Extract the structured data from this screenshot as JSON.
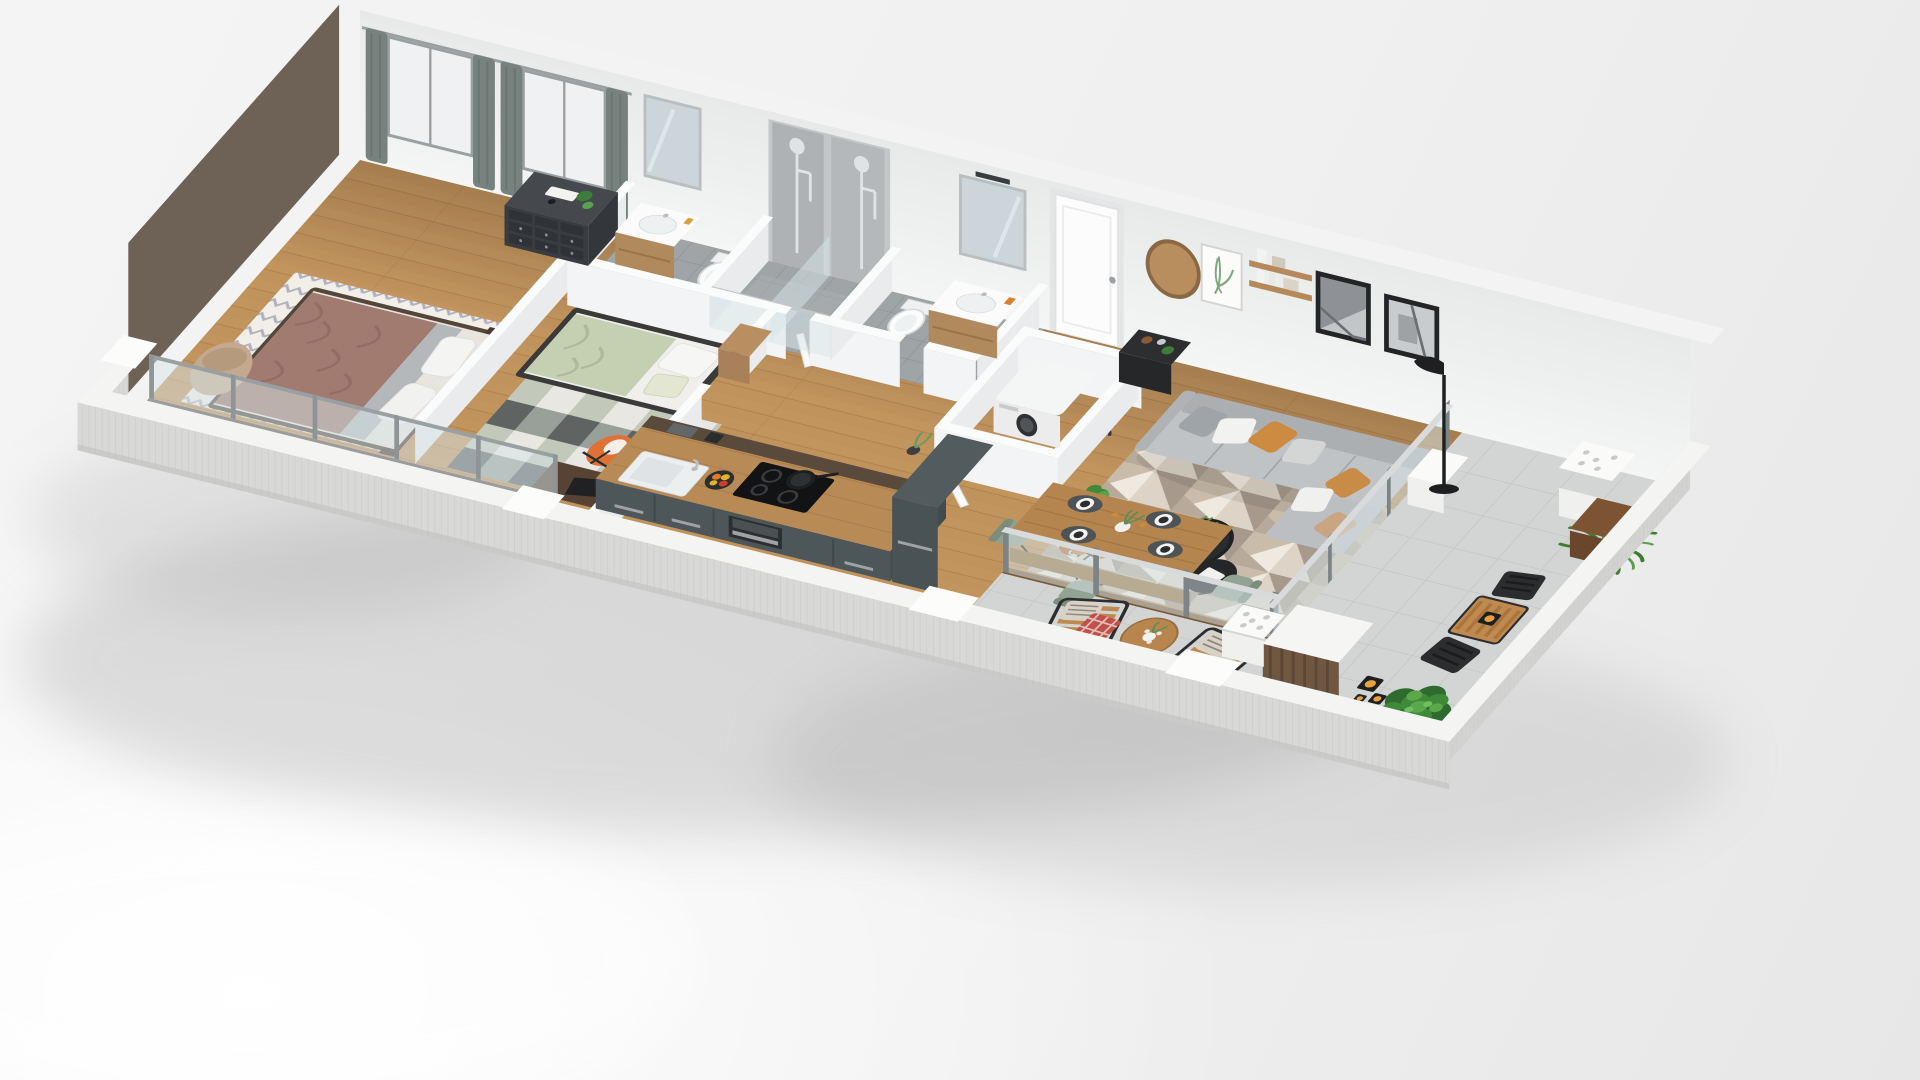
{
  "scene": {
    "type": "3d-floor-plan-render",
    "description": "Isometric cutaway 3D rendering of a furnished one-level apartment with wrap terrace, no visible text labels",
    "rooms": [
      {
        "name": "master-bedroom",
        "label": "Master bedroom",
        "furniture": [
          "double bed with mauve blanket",
          "chevron rug",
          "dark 9-drawer dresser",
          "beige floor cushion",
          "two curtained frosted windows"
        ]
      },
      {
        "name": "bedroom-2",
        "label": "Second bedroom",
        "furniture": [
          "single bed with sage duvet",
          "wood nightstand with black lamp",
          "checkered rug",
          "dark desk",
          "orange shell chair"
        ]
      },
      {
        "name": "bathroom-1",
        "label": "En-suite bathroom",
        "furniture": [
          "wood vanity with sink and mirror",
          "wall-hung toilet",
          "walk-in shower with glass screen"
        ]
      },
      {
        "name": "bathroom-2",
        "label": "Second bathroom",
        "furniture": [
          "wood vanity with sink and mirror",
          "wall-hung toilet",
          "walk-in shower"
        ]
      },
      {
        "name": "entrance-hall",
        "label": "Entrance hall",
        "furniture": [
          "white entrance door",
          "round wood mirror",
          "dark console table with plants"
        ]
      },
      {
        "name": "laundry-closet",
        "label": "Laundry closet",
        "furniture": [
          "washing machine",
          "wicker basket",
          "drying rack",
          "open white door"
        ]
      },
      {
        "name": "kitchen",
        "label": "Kitchen",
        "furniture": [
          "gray-green island with wood top",
          "white sink with chrome tap",
          "black induction hob with pan",
          "built-in oven",
          "tall cabinet",
          "coffee machine",
          "fruit bowl"
        ]
      },
      {
        "name": "dining-area",
        "label": "Dining area",
        "furniture": [
          "wood dining table",
          "4 sage shell chairs",
          "4 place settings with placemats and plates",
          "plant centerpiece"
        ]
      },
      {
        "name": "living-room",
        "label": "Living room",
        "furniture": [
          "gray sectional sofa with chaise",
          "white ochre and gray cushions",
          "2 black-framed artworks",
          "geometric patchwork rug",
          "2 round black coffee tables",
          "cognac leather armchair with houndstooth throw",
          "black floor lamp",
          "potted plants",
          "wood wall shelves",
          "botanical print"
        ]
      },
      {
        "name": "balcony-strip",
        "label": "Bedroom balcony strip",
        "furniture": [
          "glass sliding doors",
          "concrete parapet with white caps"
        ]
      },
      {
        "name": "terrace",
        "label": "Terrace",
        "furniture": [
          "2 slatted wood lounge chairs",
          "striped cushions",
          "red plaid throw",
          "round wood side table with flowers",
          "black candle lanterns",
          "bistro table with 2 black folding chairs",
          "potted palm",
          "large green plant",
          "wood storage cabinet with white top",
          "white planter boxes"
        ]
      }
    ],
    "palette": {
      "background": "#efeff0",
      "exterior_wall": "#d8d8d6",
      "accent_wall_dark": "#6e6257",
      "interior_wall": "#eff0f1",
      "wood_floor": "#c2955f",
      "bath_tile": "#9fa4a6",
      "terrace_tile": "#d3d5d5",
      "balcony_floor": "#9c9c9a",
      "kitchen_cabinet": "#4d5659",
      "counter_wood": "#b78a56",
      "sofa_gray": "#c0c3c5",
      "cushion_ochre": "#cd8a41",
      "chair_orange": "#df7136",
      "bedding_sage": "#c5cfb2",
      "blanket_mauve": "#a17a70",
      "rug_cream": "#efe9df",
      "plant_green": "#3f8a38",
      "glass_tint": "#d8e6ea"
    }
  }
}
